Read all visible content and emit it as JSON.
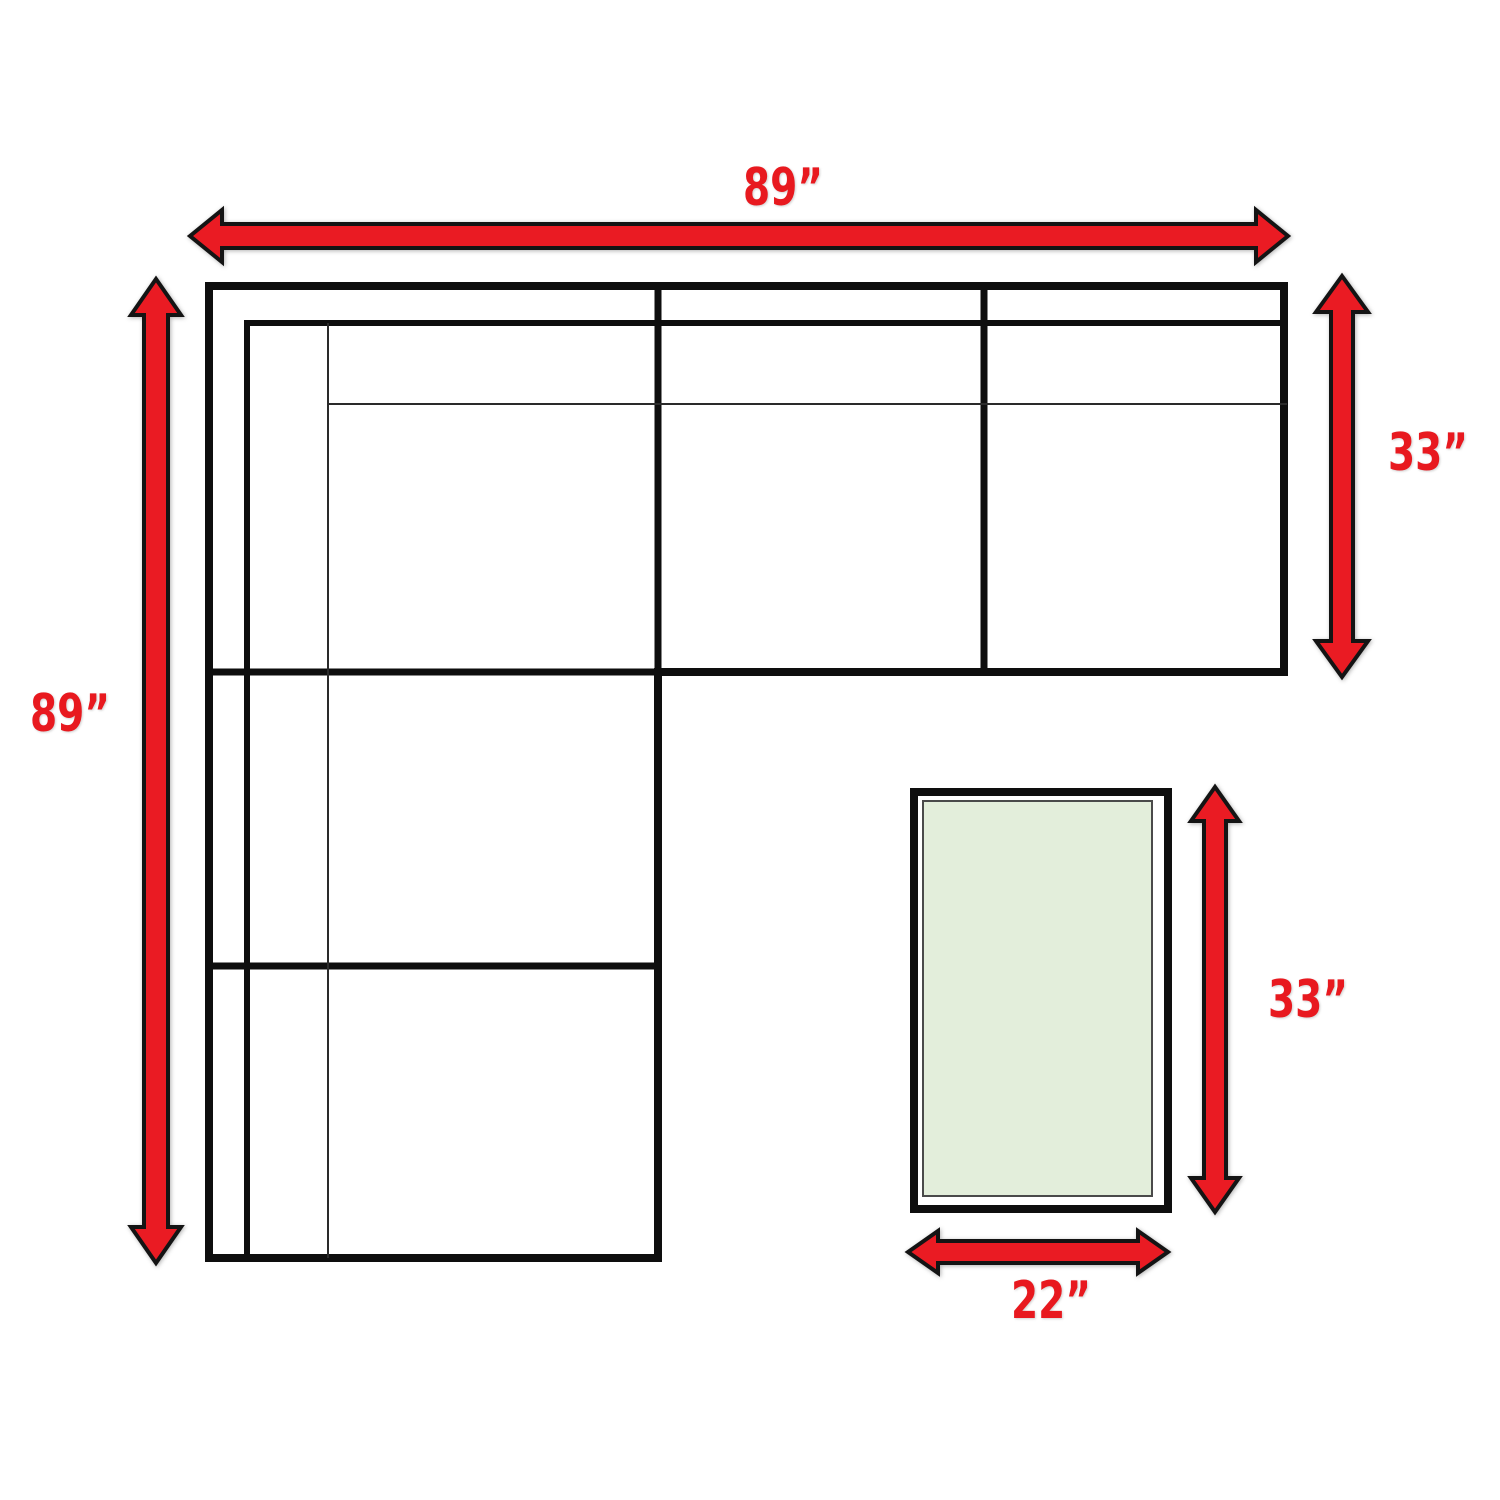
{
  "diagram": {
    "sofa": {
      "width": "89”",
      "height": "89”",
      "depth": "33”"
    },
    "ottoman": {
      "length": "33”",
      "width": "22”"
    },
    "colors": {
      "arrow_fill": "#ea1b23",
      "label_red": "#e8191f",
      "line_black": "#0e0e0e",
      "ottoman_fill": "#e3eedb"
    }
  }
}
